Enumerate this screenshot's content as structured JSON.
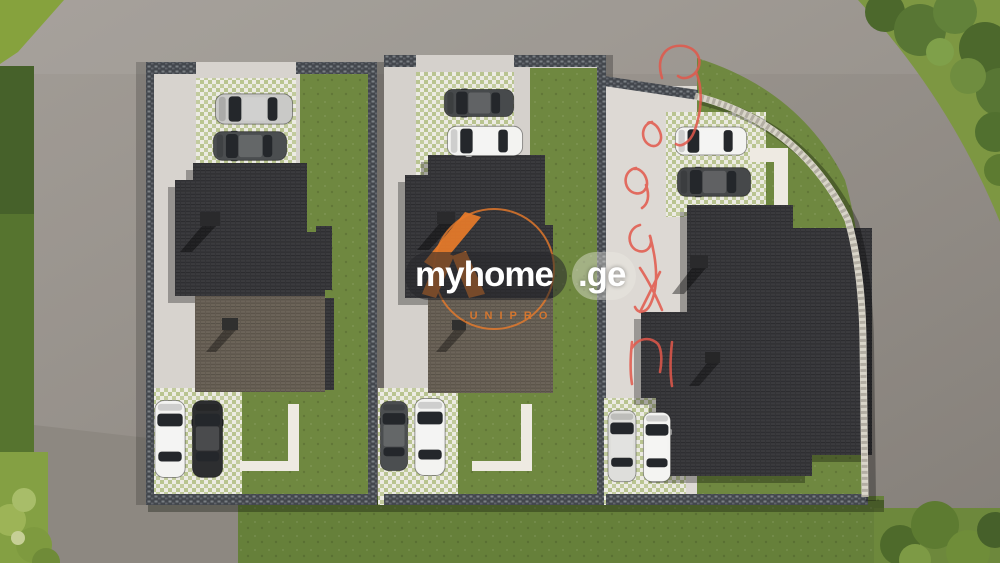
{
  "image": {
    "kind": "aerial-3d-architectural-render",
    "subject": "Top-down site plan render of three residential plots with dark tiled roofs, parked cars, paver driveways, lawns and surrounding access roads"
  },
  "watermark": {
    "brand": "myhome",
    "domain": ".ge",
    "agency": "UNIPRO",
    "accent_color": "#e87b2a"
  },
  "annotation": {
    "kind": "handwritten-marker-scribble",
    "color": "#e2584b",
    "location": "vertical along right plot driveway and top-right road",
    "legible": false
  },
  "palette": {
    "road": "#97918a",
    "concrete": "#d7d3ce",
    "driveway_bright": "#ddd9d4",
    "lawn": "#6f8840",
    "lawn_bright": "#86a23d",
    "lawn_dark": "#4f6a2e",
    "roof_dark": "#3b3b3e",
    "roof_light": "#6c6459",
    "wall_stone": "#43474d",
    "curved_wall": "#d9d5c9",
    "paver_white": "#ecebe3",
    "paver_green": "#b9c490",
    "path": "#eeeae2"
  },
  "scene": {
    "plots": [
      {
        "id": 1,
        "position": "left",
        "features": [
          "top parking pavers",
          "two-tone stepped roof",
          "two chimneys",
          "right lawn strip",
          "bottom parking",
          "L-shaped garden path"
        ],
        "cars": [
          {
            "spot": "top-1",
            "color": "silver"
          },
          {
            "spot": "top-2",
            "color": "dark-gray"
          },
          {
            "spot": "bottom-1",
            "color": "white"
          },
          {
            "spot": "bottom-2",
            "color": "black"
          }
        ]
      },
      {
        "id": 2,
        "position": "middle",
        "features": [
          "top parking pavers",
          "two-tone stepped roof",
          "two chimneys",
          "right lawn strip",
          "bottom parking",
          "L-shaped garden path"
        ],
        "cars": [
          {
            "spot": "top-1",
            "color": "dark-gray"
          },
          {
            "spot": "top-2",
            "color": "white"
          },
          {
            "spot": "bottom-1",
            "color": "dark-gray"
          },
          {
            "spot": "bottom-2",
            "color": "white"
          }
        ]
      },
      {
        "id": 3,
        "position": "right-corner",
        "features": [
          "wide bright driveway",
          "curved stone boundary wall",
          "large dark roof",
          "two chimneys",
          "corner lawn",
          "bottom parking",
          "white walkways"
        ],
        "cars": [
          {
            "spot": "top-1",
            "color": "white"
          },
          {
            "spot": "top-2",
            "color": "dark-gray"
          },
          {
            "spot": "bottom-1",
            "color": "silver-white"
          },
          {
            "spot": "bottom-2",
            "color": "white"
          }
        ]
      }
    ],
    "surroundings": [
      "wide gray road on top",
      "diagonal road on left",
      "curved road around top-right corner",
      "trees in top-right corner",
      "bushes bottom-left and bottom-right",
      "large lawn strip along bottom"
    ]
  }
}
